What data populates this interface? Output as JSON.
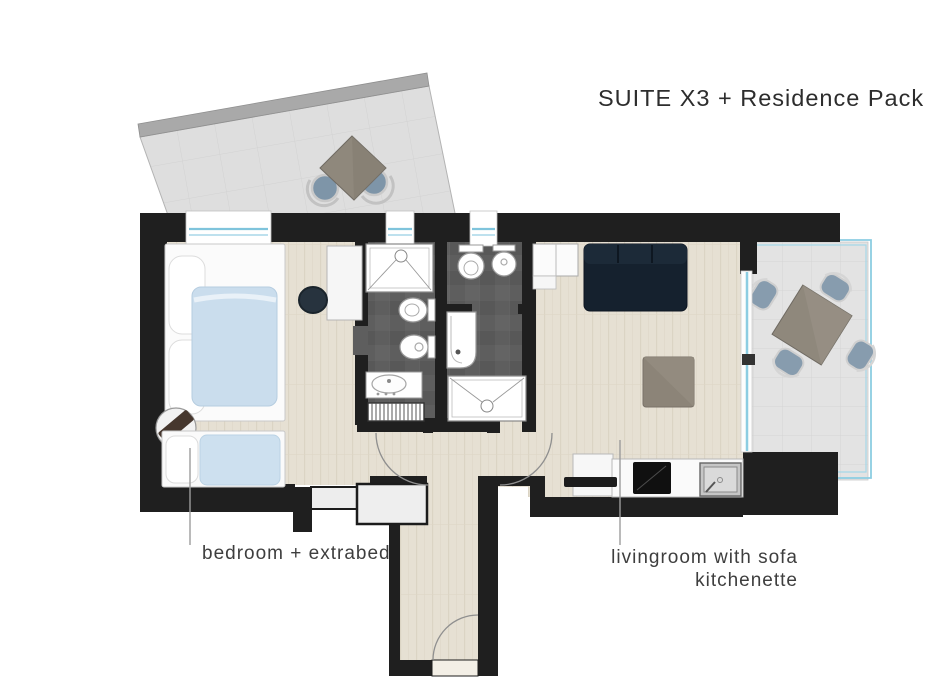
{
  "title": "SUITE X3 + Residence Pack",
  "labels": {
    "bedroom": "bedroom + extrabed",
    "living_line1": "livingroom with sofa",
    "living_line2": "kitchenette"
  },
  "colors": {
    "wall": "#1f1f1f",
    "wood_floor": "#e6e0d3",
    "bathroom_floor": "#5e5e5e",
    "terrace_floor": "#e3e3e3",
    "terrace_parapet": "#a9a9a9",
    "glass_window": "#8ccde2",
    "sofa_navy": "#15212e",
    "duvet_blue": "#cadded",
    "table_taupe": "#8f887c",
    "chair_seat": "#7e95a8",
    "label_text": "#3e3e3e",
    "leader_line": "#9c9c9c"
  }
}
